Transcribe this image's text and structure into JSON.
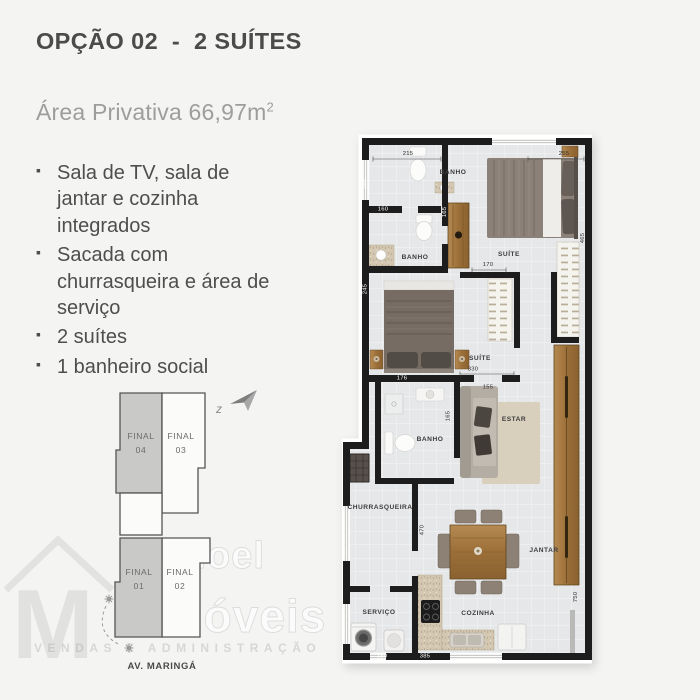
{
  "page": {
    "background": "#f4f4f2"
  },
  "header": {
    "title": "OPÇÃO 02  -  2 SUÍTES",
    "area_label": "Área Privativa 66,97m",
    "area_exponent": "2"
  },
  "features": {
    "items": [
      "Sala de TV, sala de jantar e cozinha integrados",
      "Sacada com churrasqueira e área de serviço",
      "2 suítes",
      "1 banheiro social"
    ]
  },
  "key_plan": {
    "compass_letter": "z",
    "street": "AV. MARINGÁ",
    "units": [
      {
        "label": "FINAL",
        "number": "04"
      },
      {
        "label": "FINAL",
        "number": "03"
      },
      {
        "label": "FINAL",
        "number": "01"
      },
      {
        "label": "FINAL",
        "number": "02"
      }
    ]
  },
  "watermark": {
    "word1": "Manoel",
    "word2": "Imóveis",
    "tagline": "VENDAS E ADMINISTRAÇÃO"
  },
  "plan": {
    "rooms": [
      {
        "name": "BANHO"
      },
      {
        "name": "SUÍTE"
      },
      {
        "name": "BANHO"
      },
      {
        "name": "SUÍTE"
      },
      {
        "name": "BANHO"
      },
      {
        "name": "ESTAR"
      },
      {
        "name": "CHURRASQUEIRA"
      },
      {
        "name": "JANTAR"
      },
      {
        "name": "SERVIÇO"
      },
      {
        "name": "COZINHA"
      }
    ],
    "dims": [
      {
        "v": "215"
      },
      {
        "v": "255"
      },
      {
        "v": "165"
      },
      {
        "v": "165"
      },
      {
        "v": "160"
      },
      {
        "v": "170"
      },
      {
        "v": "465"
      },
      {
        "v": "245"
      },
      {
        "v": "330"
      },
      {
        "v": "176"
      },
      {
        "v": "155"
      },
      {
        "v": "165"
      },
      {
        "v": "470"
      },
      {
        "v": "750"
      },
      {
        "v": "150"
      },
      {
        "v": "385"
      }
    ],
    "colors": {
      "wall": "#1d1d1d",
      "floor": "#e6e7e9",
      "wood": "#a87b45"
    }
  }
}
